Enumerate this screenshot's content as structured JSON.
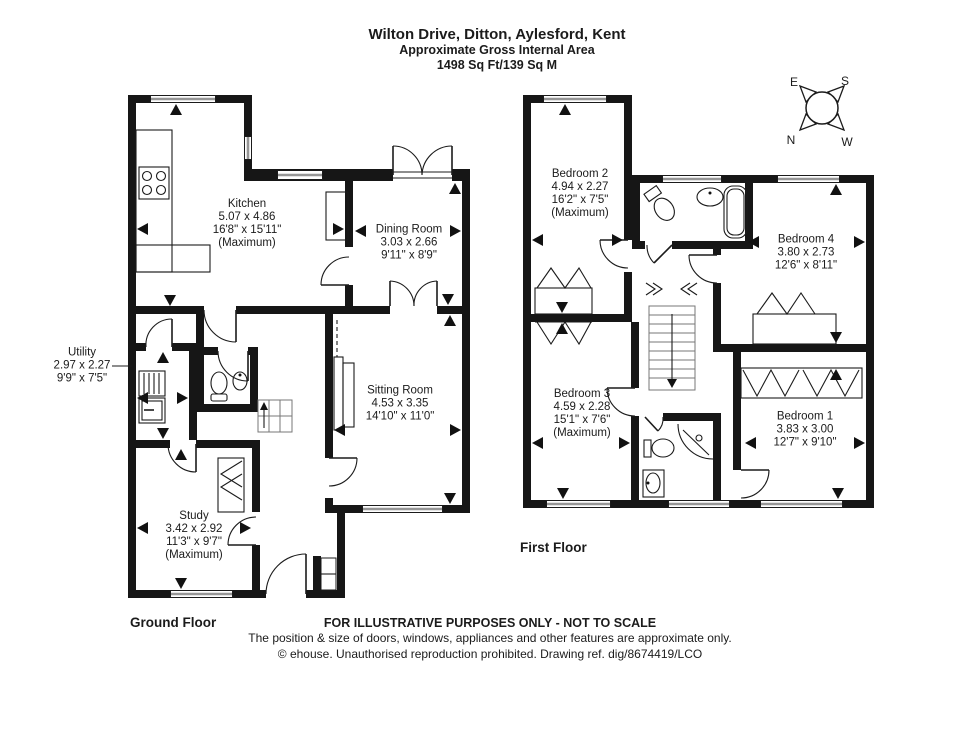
{
  "title": {
    "line1": "Wilton Drive, Ditton, Aylesford, Kent",
    "line2": "Approximate Gross Internal Area",
    "line3": "1498 Sq Ft/139 Sq M"
  },
  "floors": {
    "ground": {
      "label": "Ground Floor"
    },
    "first": {
      "label": "First Floor"
    }
  },
  "rooms": {
    "kitchen": {
      "name": "Kitchen",
      "metric": "5.07 x 4.86",
      "imperial": "16'8\" x 15'11\"",
      "note": "(Maximum)"
    },
    "dining": {
      "name": "Dining Room",
      "metric": "3.03 x 2.66",
      "imperial": "9'11\" x 8'9\""
    },
    "utility": {
      "name": "Utility",
      "metric": "2.97 x 2.27",
      "imperial": "9'9\" x 7'5\""
    },
    "sitting": {
      "name": "Sitting Room",
      "metric": "4.53 x 3.35",
      "imperial": "14'10\" x 11'0\""
    },
    "study": {
      "name": "Study",
      "metric": "3.42 x 2.92",
      "imperial": "11'3\" x 9'7\"",
      "note": "(Maximum)"
    },
    "bedroom2": {
      "name": "Bedroom 2",
      "metric": "4.94 x 2.27",
      "imperial": "16'2\" x 7'5\"",
      "note": "(Maximum)"
    },
    "bedroom4": {
      "name": "Bedroom 4",
      "metric": "3.80 x 2.73",
      "imperial": "12'6\" x 8'11\""
    },
    "bedroom3": {
      "name": "Bedroom 3",
      "metric": "4.59 x 2.28",
      "imperial": "15'1\" x 7'6\"",
      "note": "(Maximum)"
    },
    "bedroom1": {
      "name": "Bedroom 1",
      "metric": "3.83 x 3.00",
      "imperial": "12'7\" x 9'10\""
    }
  },
  "compass": {
    "n": "N",
    "e": "E",
    "s": "S",
    "w": "W"
  },
  "footer": {
    "line1": "FOR ILLUSTRATIVE PURPOSES ONLY - NOT TO SCALE",
    "line2": "The position & size of doors, windows, appliances and other features are approximate only.",
    "line3": "© ehouse. Unauthorised reproduction prohibited. Drawing ref. dig/8674419/LCO"
  },
  "colors": {
    "wall": "#161616",
    "window_bar": "#969696",
    "text": "#1b1b1b"
  }
}
